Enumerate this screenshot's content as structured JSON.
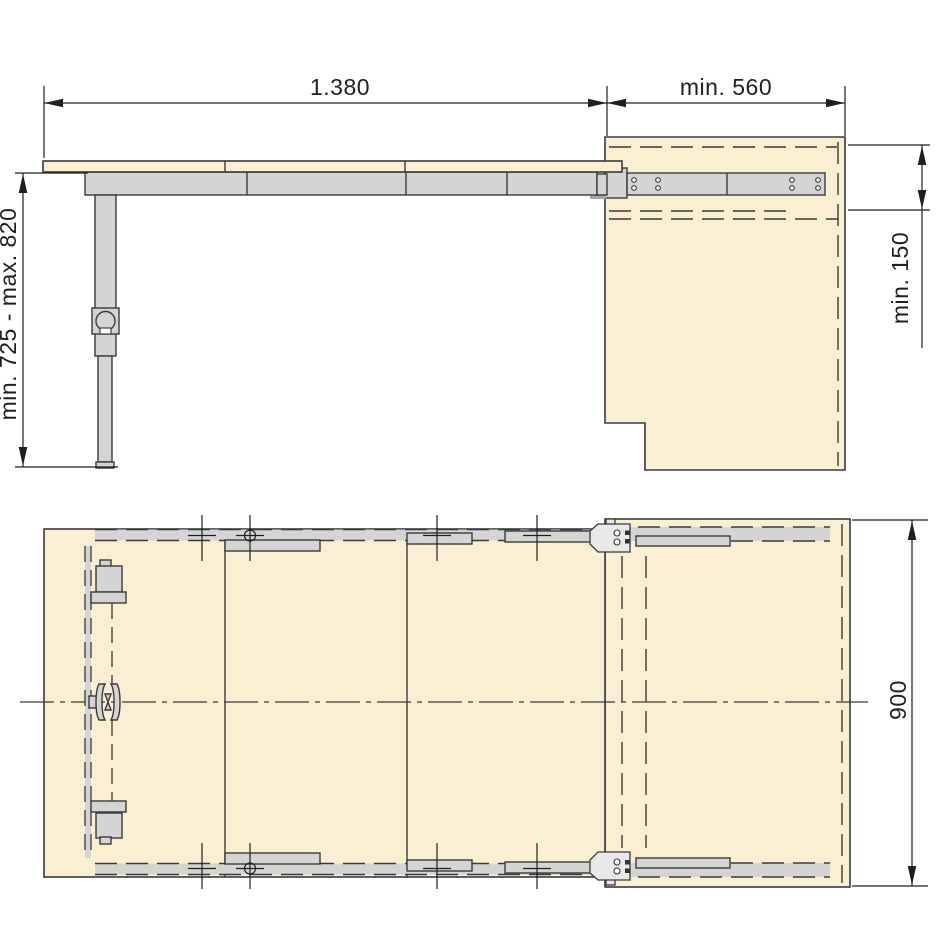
{
  "dimensions": {
    "pull_out_length": "1.380",
    "cabinet_depth": "min. 560",
    "height_range": "min. 725 - max. 820",
    "rail_zone_height": "min. 150",
    "table_depth": "900"
  },
  "colors": {
    "background": "#ffffff",
    "wood": "#faeed3",
    "metal": "#d4d4d4",
    "metal_dark": "#a8a8a8",
    "bracket_light": "#e9e9e9",
    "line": "#3a3a3a",
    "dim": "#1f1f1f"
  }
}
